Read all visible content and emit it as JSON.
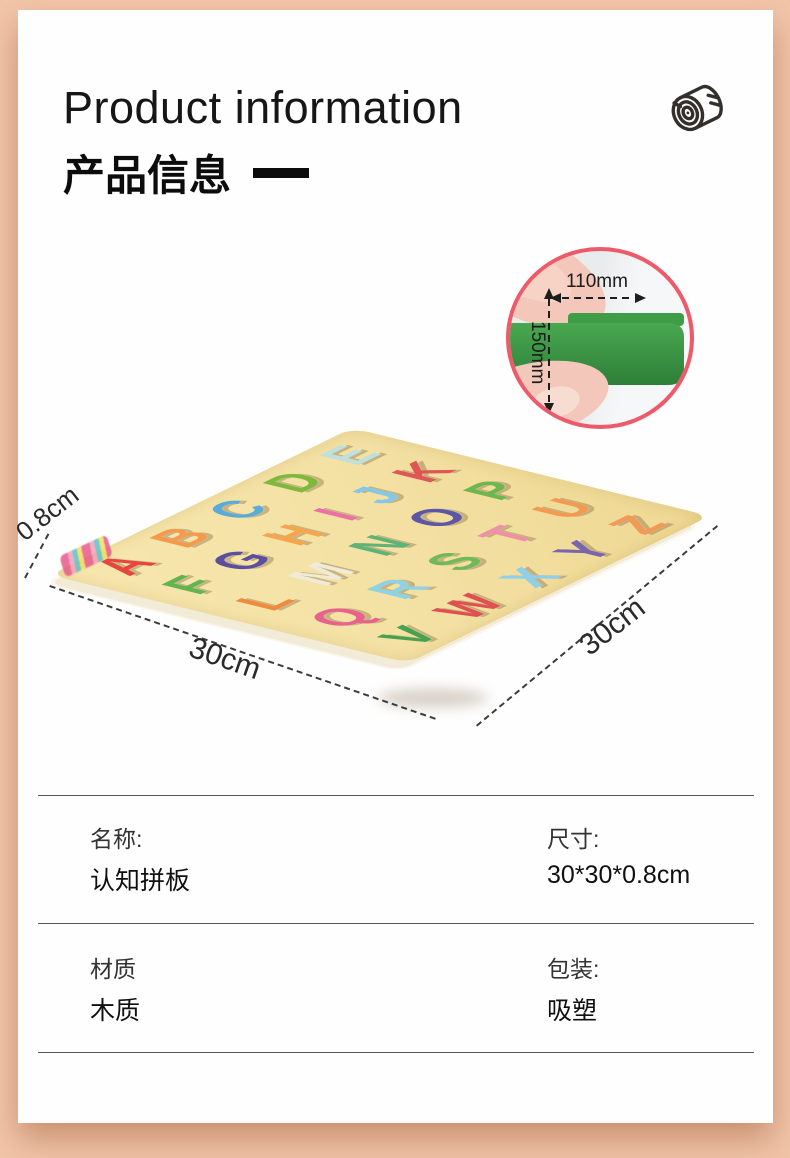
{
  "frame": {
    "bg_color": "#f2c5a9",
    "panel_color": "#fefefe"
  },
  "header": {
    "title_en": "Product information",
    "title_zh": "产品信息",
    "dash": "一",
    "icon": "wood-log"
  },
  "inset": {
    "width_label": "110mm",
    "height_label": "150mm",
    "ring_color": "#ee5a6a",
    "piece_color": "#3f9d48"
  },
  "photo": {
    "thickness_label": "0.8cm",
    "width_label": "30cm",
    "depth_label": "30cm",
    "board_color": "#f3e0a2",
    "row_breaks": [
      5,
      11,
      16,
      21,
      26
    ],
    "letters": [
      {
        "ch": "A",
        "color": "#e8453f"
      },
      {
        "ch": "B",
        "color": "#f59a4c"
      },
      {
        "ch": "C",
        "color": "#5aacd8"
      },
      {
        "ch": "D",
        "color": "#7dba3c"
      },
      {
        "ch": "E",
        "color": "#bfe0dc"
      },
      {
        "ch": "F",
        "color": "#62b44e"
      },
      {
        "ch": "G",
        "color": "#5a4f9e"
      },
      {
        "ch": "H",
        "color": "#f5a54b"
      },
      {
        "ch": "I",
        "color": "#ee6fa5"
      },
      {
        "ch": "J",
        "color": "#82c8e8"
      },
      {
        "ch": "K",
        "color": "#e25555"
      },
      {
        "ch": "L",
        "color": "#f08a3c"
      },
      {
        "ch": "M",
        "color": "#f0ead8"
      },
      {
        "ch": "N",
        "color": "#5eb376"
      },
      {
        "ch": "O",
        "color": "#5d55a5"
      },
      {
        "ch": "P",
        "color": "#6cb84f"
      },
      {
        "ch": "Q",
        "color": "#e8638c"
      },
      {
        "ch": "R",
        "color": "#8ed3e4"
      },
      {
        "ch": "S",
        "color": "#6fba58"
      },
      {
        "ch": "T",
        "color": "#f090a8"
      },
      {
        "ch": "U",
        "color": "#f49a50"
      },
      {
        "ch": "V",
        "color": "#46a24e"
      },
      {
        "ch": "W",
        "color": "#e05050"
      },
      {
        "ch": "X",
        "color": "#8fd0e8"
      },
      {
        "ch": "Y",
        "color": "#7a64ad"
      },
      {
        "ch": "Z",
        "color": "#f29a55"
      }
    ]
  },
  "specs": {
    "rows": [
      {
        "left_label": "名称:",
        "left_value": "认知拼板",
        "right_label": "尺寸:",
        "right_value": "30*30*0.8cm"
      },
      {
        "left_label": "材质",
        "left_value": "木质",
        "right_label": "包装:",
        "right_value": "吸塑"
      }
    ]
  }
}
